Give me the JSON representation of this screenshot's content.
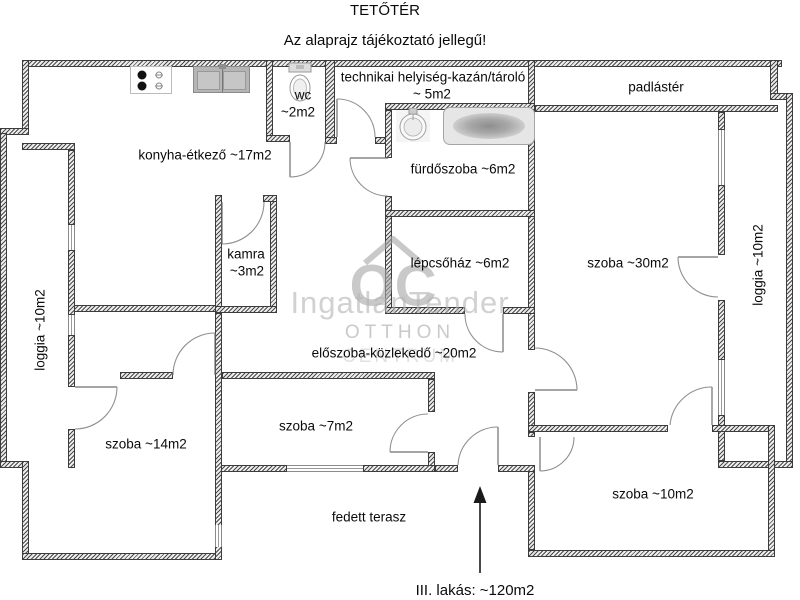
{
  "title": "TETŐTÉR",
  "subtitle": "Az alaprajz tájékoztató jellegű!",
  "rooms": {
    "konyha": "konyha-étkező ~17m2",
    "wc": "wc",
    "wc_area": "~2m2",
    "technikai": "technikai helyiség-kazán/tároló",
    "technikai_area": "~ 5m2",
    "padlaster": "padlástér",
    "furdoszoba": "fürdőszoba ~6m2",
    "kamra": "kamra",
    "kamra_area": "~3m2",
    "lepcsohaz": "lépcsőház ~6m2",
    "szoba_30": "szoba ~30m2",
    "loggia_left": "loggia ~10m2",
    "loggia_right": "loggia ~10m2",
    "eloszoba": "előszoba-közlekedő ~20m2",
    "szoba_14": "szoba ~14m2",
    "szoba_7": "szoba ~7m2",
    "szoba_10": "szoba ~10m2",
    "terasz": "fedett terasz"
  },
  "annotation": "III. lakás: ~120m2",
  "watermark": {
    "brand": "IngatlanTender",
    "logo": "OC",
    "line1": "OTTHON",
    "line2": "CENTRUM"
  },
  "icons": [
    "stove-icon",
    "sink-icon",
    "toilet-icon",
    "washbasin-icon",
    "bathtub-icon",
    "up-arrow-icon"
  ],
  "colors": {
    "wall_hatch": "#4a4a4a",
    "wall_outline": "#3c3c3c",
    "door_arc": "#8f8f8f",
    "fixture_gray": "#b5b5b5",
    "watermark_gray": "#b0b0b0",
    "text": "#0a0a0a"
  }
}
